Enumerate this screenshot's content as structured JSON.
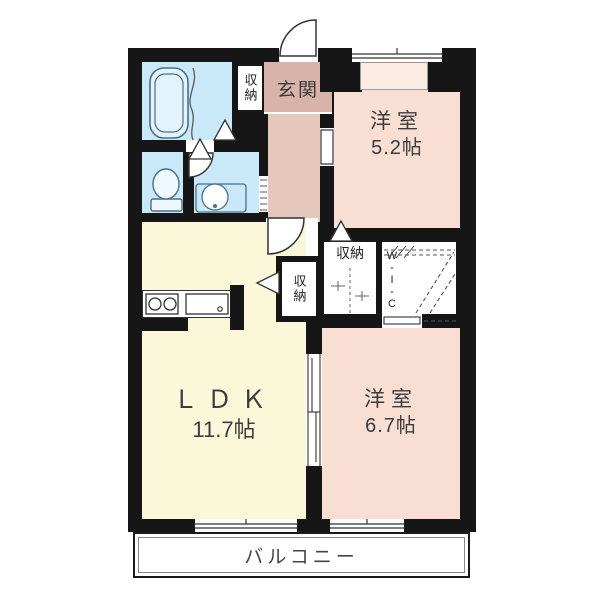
{
  "plan_type": "apartment-floorplan",
  "rooms": {
    "entrance": {
      "label": "玄関"
    },
    "bedroom_small": {
      "label": "洋室",
      "size": "5.2帖"
    },
    "bedroom_large": {
      "label": "洋室",
      "size": "6.7帖"
    },
    "ldk": {
      "label": "ＬＤＫ",
      "size": "11.7帖"
    },
    "wic": {
      "label": "W-I-C"
    },
    "balcony": {
      "label": "バルコニー"
    },
    "storage_entrance": {
      "label": "収納"
    },
    "storage_ldk": {
      "label": "収納"
    },
    "storage_bedroom": {
      "label": "収納"
    }
  },
  "colors": {
    "wall": "#161616",
    "bedroom": "#f8ded3",
    "bay": "#fcece4",
    "ldk": "#fbf7d9",
    "water": "#c9e9f8",
    "hall": "#e5c7bc",
    "genkan": "#d7b3a9",
    "fixture": "#4a7085",
    "line": "#3a3a3a"
  }
}
